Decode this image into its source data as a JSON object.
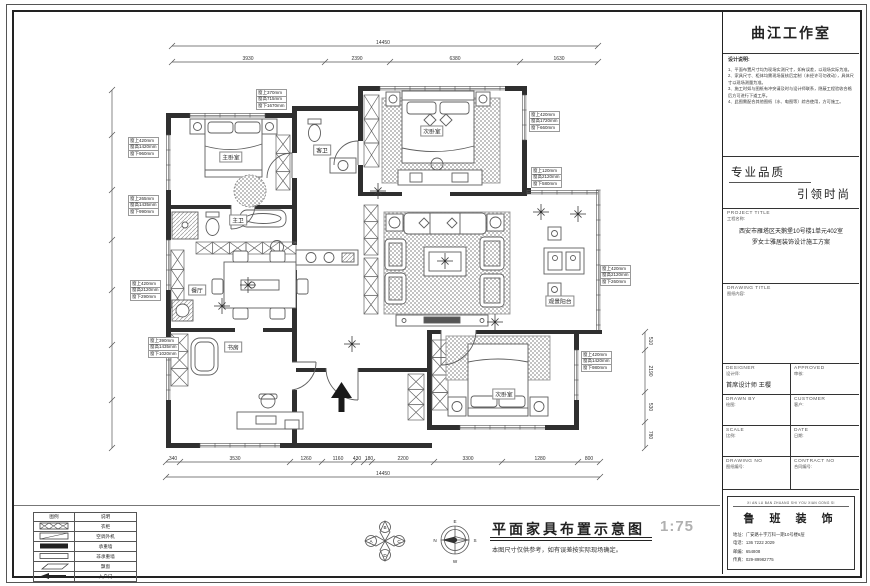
{
  "sheet": {
    "studio": "曲江工作室",
    "notes_title": "设计说明:",
    "notes": [
      "1、平面布置尺寸均为现场实测尺寸，如有误差，以现场实际为准。",
      "2、家具尺寸、柜体均需现场复核后定制（未经许可勿改动），具体尺寸以现场测量为准。",
      "3、施工时如与图纸有冲突请及时与设计师联系，隐蔽工程验收合格后方可进行下道工序。",
      "4、此图需配合其他图纸（水、电图等）综合使用，方可施工。"
    ],
    "quality_line1": "专业品质",
    "quality_line2": "引领时尚",
    "project_title_en": "PROJECT TITLE",
    "project_title_cn": "工程名称:",
    "project_name_line1": "西安市雁塔区天鹅堡10号楼1单元402室",
    "project_name_line2": "罗女士雅居装饰设计施工方案",
    "drawing_title_en": "DRAWING TITLE",
    "drawing_title_cn": "图纸内容:",
    "fields": {
      "designer_en": "DESIGNER",
      "designer_cn": "设计师:",
      "designer_value": "首席设计师 王樱",
      "approved_en": "APPROVED",
      "approved_cn": "审核:",
      "drawn_en": "DRAWN BY",
      "drawn_cn": "绘图:",
      "customer_en": "CUSTOMER",
      "customer_cn": "客户:",
      "scale_en": "SCALE",
      "scale_cn": "比例:",
      "date_en": "DATE",
      "date_cn": "日期:",
      "drawingno_en": "DRAWING NO",
      "drawingno_cn": "图纸编号:",
      "contractno_en": "CONTRACT NO",
      "contractno_cn": "合同编号:"
    },
    "company": {
      "en_line": "XI AN LU BAN ZHUANG SHI YOU XIAN GONG SI",
      "name": "鲁 班 装 饰",
      "address": "地址：广安路十字万科一期10号楼6层",
      "phone": "电话：136 7222 2029",
      "post": "邮编：654808",
      "fax": "传真：029-89982775"
    }
  },
  "legend": {
    "header_symbol": "图例",
    "header_desc": "说明",
    "rows": [
      {
        "symbol": "wardrobe",
        "desc": "衣柜"
      },
      {
        "symbol": "ac-unit",
        "desc": "空调外机"
      },
      {
        "symbol": "bearing-wall",
        "desc": "承重墙"
      },
      {
        "symbol": "non-bearing-wall",
        "desc": "非承重墙"
      },
      {
        "symbol": "bay-window",
        "desc": "飘窗"
      },
      {
        "symbol": "entry-door",
        "desc": "入户门"
      }
    ]
  },
  "caption": {
    "title": "平面家具布置示意图",
    "scale": "1:75",
    "note": "本图尺寸仅供参考，如有误差按实际现场确定。",
    "compass": {
      "n": "N",
      "e": "E",
      "s": "S",
      "w": "W",
      "a": "A",
      "b": "B",
      "c": "C",
      "d": "D"
    }
  },
  "plan": {
    "room_labels": [
      {
        "text": "主卧室",
        "x": 231,
        "y": 157
      },
      {
        "text": "主卫",
        "x": 238,
        "y": 220
      },
      {
        "text": "客卫",
        "x": 322,
        "y": 150
      },
      {
        "text": "次卧室",
        "x": 432,
        "y": 131
      },
      {
        "text": "餐厅",
        "x": 197,
        "y": 290
      },
      {
        "text": "书房",
        "x": 233,
        "y": 347
      },
      {
        "text": "观景阳台",
        "x": 560,
        "y": 301
      },
      {
        "text": "次卧室",
        "x": 504,
        "y": 394
      }
    ],
    "window_labels": [
      {
        "x": 128,
        "y": 138,
        "lines": [
          "窗上420mm",
          "窗高1420mm",
          "窗下960mm"
        ]
      },
      {
        "x": 128,
        "y": 196,
        "lines": [
          "窗上265mm",
          "窗高1435mm",
          "窗下990mm"
        ]
      },
      {
        "x": 130,
        "y": 281,
        "lines": [
          "窗上420mm",
          "窗高2120mm",
          "窗下290mm"
        ]
      },
      {
        "x": 148,
        "y": 338,
        "lines": [
          "窗上390mm",
          "窗高1435mm",
          "窗下1020mm"
        ]
      },
      {
        "x": 256,
        "y": 90,
        "lines": [
          "窗上370mm",
          "窗高715mm",
          "窗下1670mm"
        ]
      },
      {
        "x": 529,
        "y": 112,
        "lines": [
          "窗上420mm",
          "窗高1720mm",
          "窗下660mm"
        ]
      },
      {
        "x": 531,
        "y": 168,
        "lines": [
          "窗上120mm",
          "窗高2120mm",
          "窗下580mm"
        ]
      },
      {
        "x": 600,
        "y": 266,
        "lines": [
          "窗上420mm",
          "窗高2120mm",
          "窗下260mm"
        ]
      },
      {
        "x": 581,
        "y": 352,
        "lines": [
          "窗上420mm",
          "窗高1420mm",
          "窗下980mm"
        ]
      }
    ],
    "dims": {
      "top_overall": {
        "label": "14450",
        "x": 383,
        "y": 44,
        "x1": 172,
        "x2": 598,
        "line_y": 46
      },
      "top_segments": {
        "line_y": 62,
        "ticks": [
          172,
          325,
          390,
          520,
          598
        ],
        "labels": [
          {
            "t": "3930",
            "x": 248
          },
          {
            "t": "2390",
            "x": 357
          },
          {
            "t": "6380",
            "x": 455
          },
          {
            "t": "1630",
            "x": 559
          }
        ]
      },
      "bottom": {
        "line_y": 462,
        "ticks": [
          166,
          180,
          290,
          322,
          354,
          364,
          372,
          434,
          502,
          578,
          600
        ],
        "labels": [
          {
            "t": "340",
            "x": 173
          },
          {
            "t": "3530",
            "x": 235
          },
          {
            "t": "1260",
            "x": 306
          },
          {
            "t": "1160",
            "x": 338
          },
          {
            "t": "430",
            "x": 357
          },
          {
            "t": "180",
            "x": 369
          },
          {
            "t": "2200",
            "x": 403
          },
          {
            "t": "3300",
            "x": 468
          },
          {
            "t": "1280",
            "x": 540
          },
          {
            "t": "800",
            "x": 589
          }
        ]
      },
      "bottom_overall": {
        "label": "14450",
        "x": 383,
        "y": 475,
        "x1": 166,
        "x2": 600,
        "line_y": 477
      },
      "right": {
        "x": 645,
        "y1": 332,
        "y2": 448,
        "ticks": [
          332,
          350,
          392,
          422,
          448
        ],
        "labels": [
          {
            "t": "510",
            "y": 341
          },
          {
            "t": "2190",
            "y": 371
          },
          {
            "t": "530",
            "y": 407
          },
          {
            "t": "780",
            "y": 435
          }
        ]
      },
      "left": {
        "x": 112,
        "y1": 90,
        "y2": 448,
        "ticks": [
          90,
          135,
          190,
          240,
          290,
          345,
          400,
          448
        ]
      }
    }
  }
}
